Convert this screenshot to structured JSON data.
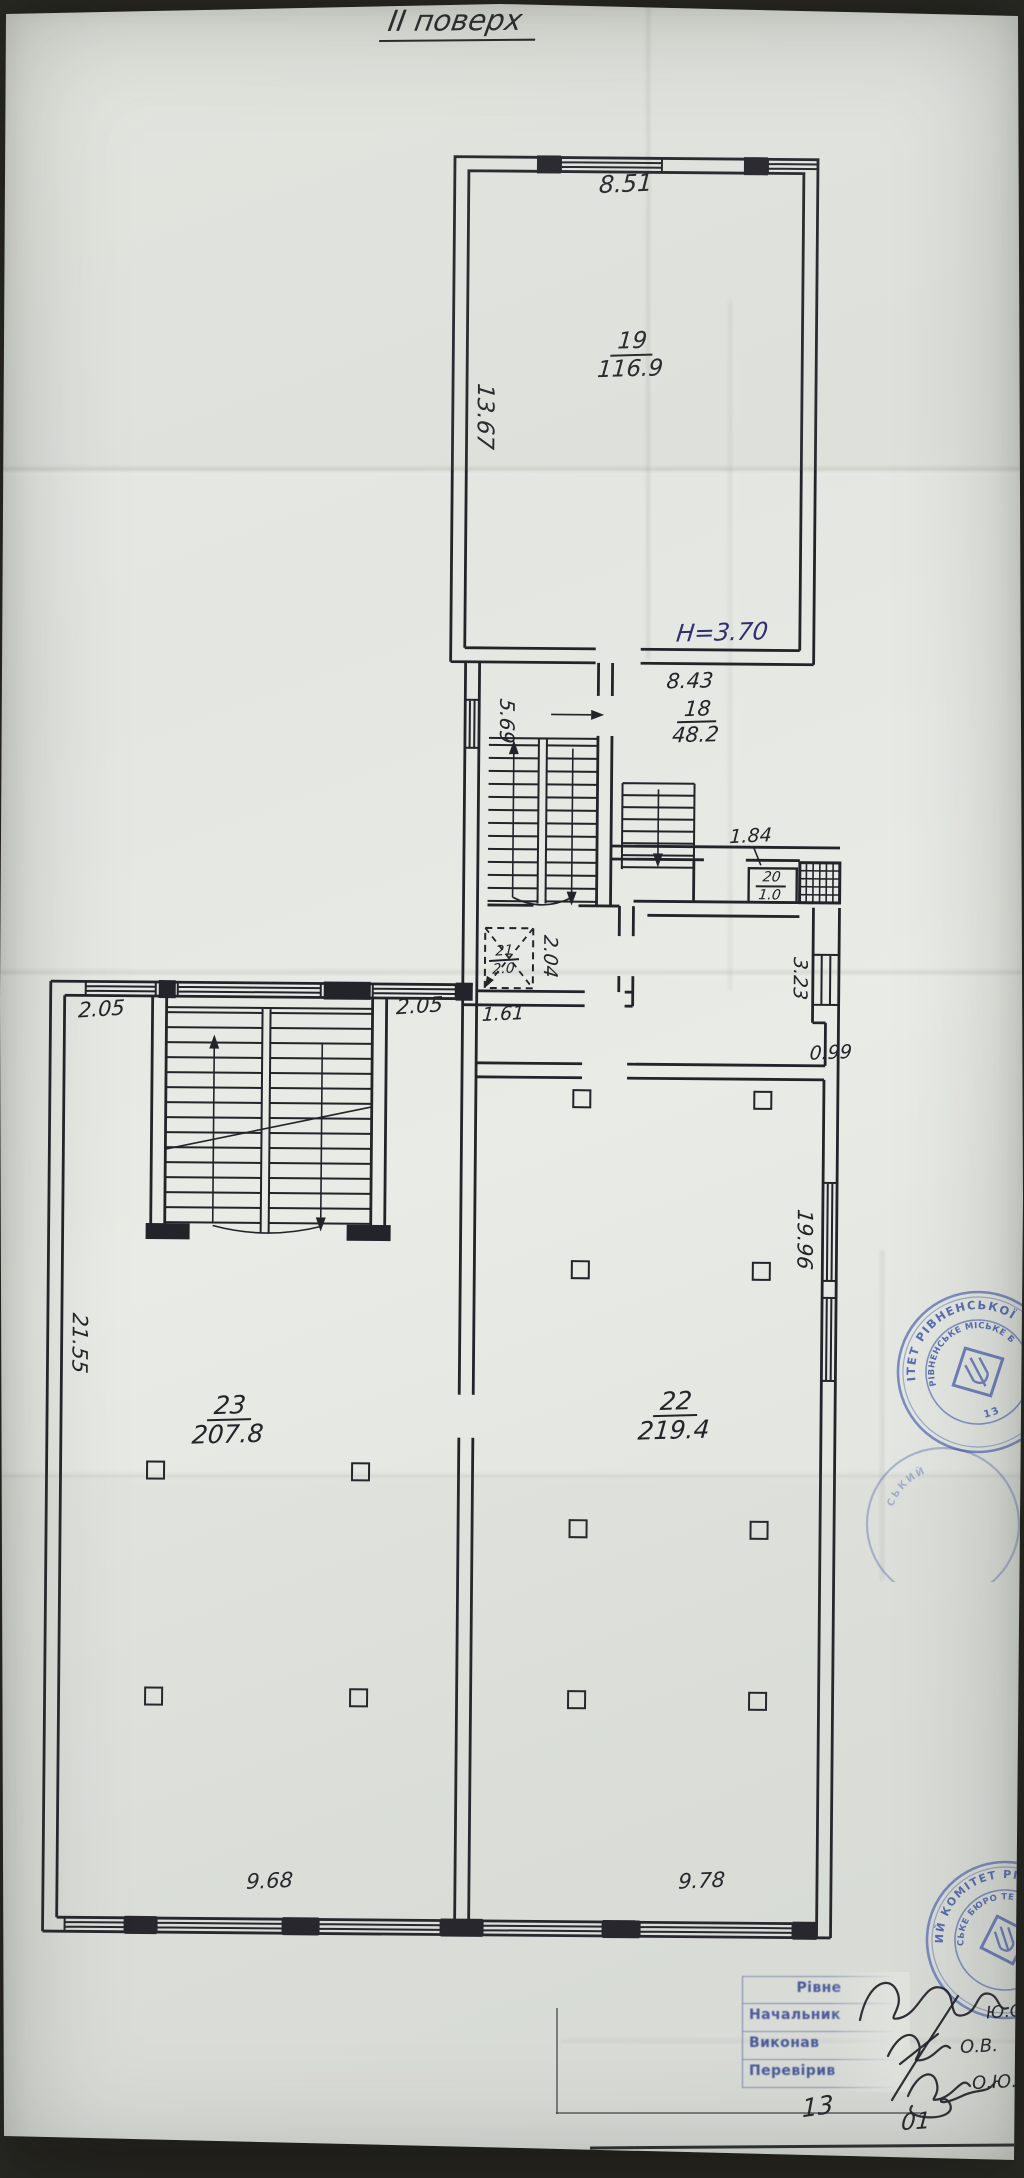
{
  "plan": {
    "title": "ІІ поверх",
    "height_note": "Н=3.70",
    "rooms": {
      "r19": {
        "number": "19",
        "area": "116.9"
      },
      "r18": {
        "number": "18",
        "area": "48.2"
      },
      "r20": {
        "number": "20",
        "area": "1.0"
      },
      "r21": {
        "number": "21",
        "area": "2.0"
      },
      "r22": {
        "number": "22",
        "area": "219.4"
      },
      "r23": {
        "number": "23",
        "area": "207.8"
      }
    },
    "dims": {
      "d851": "8.51",
      "d1367": "13.67",
      "d843": "8.43",
      "d569": "5.69",
      "d184": "1.84",
      "d204": "2.04",
      "d161": "1.61",
      "d205a": "2.05",
      "d205b": "2.05",
      "d323": "3.23",
      "d099": "0.99",
      "d1996": "19.96",
      "d2155": "21.55",
      "d968": "9.68",
      "d978": "9.78"
    }
  },
  "stamps": {
    "mid": {
      "outer_text": "ІТЕТ РІВНЕНСЬКОЇ М",
      "inner_text": "РІВНЕНСЬКЕ МІСЬКЕ БЮРО ТЕ",
      "number": "13"
    },
    "mid_ghost": "СЬКИЙ",
    "bottom": {
      "outer_text": "ИЙ КОМІТЕТ РІВНЕНС",
      "inner_text": "СЬКЕ БЮРО ТЕ"
    }
  },
  "title_block": {
    "header": "Рівне",
    "rows": [
      "Начальник",
      "Виконав",
      "Перевірив"
    ],
    "initials": [
      "Ю.О.",
      "О.В.",
      "О.Ю."
    ]
  },
  "footer": {
    "num_left": "13",
    "num_right": "01"
  }
}
